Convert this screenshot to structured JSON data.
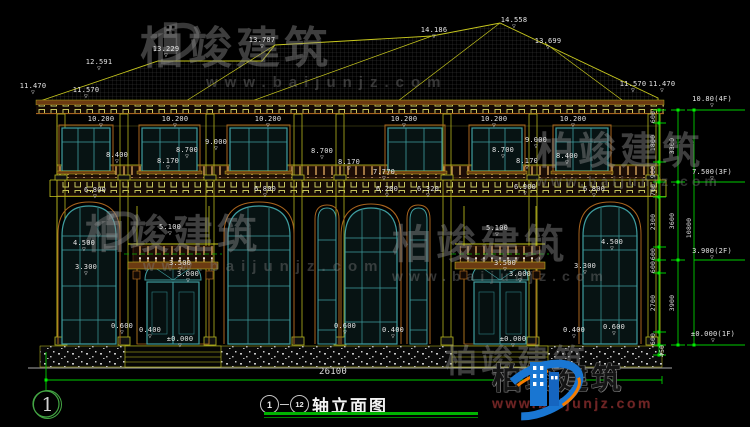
{
  "drawing": {
    "title": "轴立面图",
    "axis_from": "1",
    "axis_to": "12",
    "sheet_bubble": "1"
  },
  "watermark": {
    "brand": "柏竣建筑",
    "url": "www.baijunjz.com"
  },
  "colors": {
    "cad_yellow": "#c8c81e",
    "trim_brown": "#a8641e",
    "window_teal": "#3f9ea0",
    "dim_green": "#00cc00",
    "text_white": "#e4e4e4",
    "logo_blue": "#1976d2",
    "logo_orange": "#f57c00",
    "url_red": "#6e2424"
  },
  "labels": [
    {
      "t": "11.470",
      "x": 33,
      "y": 86,
      "lv": 1
    },
    {
      "t": "11.570",
      "x": 86,
      "y": 90,
      "lv": 1
    },
    {
      "t": "12.591",
      "x": 99,
      "y": 62,
      "lv": 1
    },
    {
      "t": "13.229",
      "x": 166,
      "y": 49,
      "lv": 1
    },
    {
      "t": "13.707",
      "x": 262,
      "y": 40,
      "lv": 1
    },
    {
      "t": "14.186",
      "x": 434,
      "y": 30,
      "lv": 1
    },
    {
      "t": "14.558",
      "x": 514,
      "y": 20,
      "lv": 1
    },
    {
      "t": "13.699",
      "x": 548,
      "y": 41,
      "lv": 1
    },
    {
      "t": "11.570",
      "x": 633,
      "y": 84,
      "lv": 1
    },
    {
      "t": "11.470",
      "x": 662,
      "y": 84,
      "lv": 1
    },
    {
      "t": "10.200",
      "x": 101,
      "y": 119,
      "lv": 1
    },
    {
      "t": "10.200",
      "x": 175,
      "y": 119,
      "lv": 1
    },
    {
      "t": "10.200",
      "x": 268,
      "y": 119,
      "lv": 1
    },
    {
      "t": "10.200",
      "x": 404,
      "y": 119,
      "lv": 1
    },
    {
      "t": "10.200",
      "x": 494,
      "y": 119,
      "lv": 1
    },
    {
      "t": "10.200",
      "x": 573,
      "y": 119,
      "lv": 1
    },
    {
      "t": "9.000",
      "x": 216,
      "y": 142,
      "lv": 1
    },
    {
      "t": "9.000",
      "x": 536,
      "y": 140,
      "lv": 1
    },
    {
      "t": "8.700",
      "x": 187,
      "y": 150,
      "lv": 1
    },
    {
      "t": "8.700",
      "x": 322,
      "y": 151,
      "lv": 1
    },
    {
      "t": "8.700",
      "x": 503,
      "y": 150,
      "lv": 1
    },
    {
      "t": "8.400",
      "x": 117,
      "y": 155,
      "lv": 1
    },
    {
      "t": "8.400",
      "x": 567,
      "y": 156,
      "lv": 1
    },
    {
      "t": "8.170",
      "x": 168,
      "y": 161,
      "lv": 1
    },
    {
      "t": "8.170",
      "x": 349,
      "y": 162,
      "lv": 1
    },
    {
      "t": "8.170",
      "x": 527,
      "y": 161,
      "lv": 1
    },
    {
      "t": "7.770",
      "x": 384,
      "y": 172,
      "lv": 1
    },
    {
      "t": "6.800",
      "x": 95,
      "y": 190,
      "lv": 1
    },
    {
      "t": "6.800",
      "x": 265,
      "y": 189,
      "lv": 1
    },
    {
      "t": "6.200",
      "x": 387,
      "y": 189,
      "lv": 1
    },
    {
      "t": "6.320",
      "x": 428,
      "y": 189,
      "lv": 1
    },
    {
      "t": "6.900",
      "x": 525,
      "y": 187,
      "lv": 1
    },
    {
      "t": "6.800",
      "x": 594,
      "y": 189,
      "lv": 1
    },
    {
      "t": "5.100",
      "x": 170,
      "y": 227,
      "lv": 1
    },
    {
      "t": "5.100",
      "x": 497,
      "y": 228,
      "lv": 1
    },
    {
      "t": "4.500",
      "x": 84,
      "y": 243,
      "lv": 1
    },
    {
      "t": "4.500",
      "x": 612,
      "y": 242,
      "lv": 1
    },
    {
      "t": "3.500",
      "x": 180,
      "y": 263,
      "lv": 1
    },
    {
      "t": "3.500",
      "x": 505,
      "y": 263,
      "lv": 1
    },
    {
      "t": "3.300",
      "x": 86,
      "y": 267,
      "lv": 1
    },
    {
      "t": "3.300",
      "x": 585,
      "y": 266,
      "lv": 1
    },
    {
      "t": "3.000",
      "x": 188,
      "y": 274,
      "lv": 1
    },
    {
      "t": "3.000",
      "x": 520,
      "y": 274,
      "lv": 1
    },
    {
      "t": "0.600",
      "x": 122,
      "y": 326,
      "lv": 1
    },
    {
      "t": "0.400",
      "x": 150,
      "y": 330,
      "lv": 1
    },
    {
      "t": "±0.000",
      "x": 180,
      "y": 339,
      "lv": 1
    },
    {
      "t": "0.600",
      "x": 345,
      "y": 326,
      "lv": 1
    },
    {
      "t": "0.400",
      "x": 393,
      "y": 330,
      "lv": 1
    },
    {
      "t": "±0.000",
      "x": 513,
      "y": 339,
      "lv": 1
    },
    {
      "t": "0.400",
      "x": 574,
      "y": 330,
      "lv": 1
    },
    {
      "t": "0.600",
      "x": 614,
      "y": 327,
      "lv": 1
    },
    {
      "t": "26100",
      "x": 333,
      "y": 372,
      "big": 1
    },
    {
      "t": "600",
      "x": 653,
      "y": 117,
      "r": 1
    },
    {
      "t": "1800",
      "x": 653,
      "y": 143,
      "r": 1
    },
    {
      "t": "900",
      "x": 653,
      "y": 172,
      "r": 1
    },
    {
      "t": "700",
      "x": 653,
      "y": 190,
      "r": 1
    },
    {
      "t": "2300",
      "x": 653,
      "y": 222,
      "r": 1
    },
    {
      "t": "600",
      "x": 653,
      "y": 254,
      "r": 1
    },
    {
      "t": "600",
      "x": 653,
      "y": 267,
      "r": 1
    },
    {
      "t": "2700",
      "x": 653,
      "y": 303,
      "r": 1
    },
    {
      "t": "600",
      "x": 653,
      "y": 339,
      "r": 1
    },
    {
      "t": "450",
      "x": 662,
      "y": 351,
      "r": 1
    },
    {
      "t": "3300",
      "x": 672,
      "y": 146,
      "r": 1
    },
    {
      "t": "3600",
      "x": 672,
      "y": 221,
      "r": 1
    },
    {
      "t": "3900",
      "x": 672,
      "y": 303,
      "r": 1
    },
    {
      "t": "10800",
      "x": 689,
      "y": 228,
      "r": 1
    },
    {
      "t": "10.80(4F)",
      "x": 712,
      "y": 99,
      "lv": 1
    },
    {
      "t": "7.500(3F)",
      "x": 712,
      "y": 172,
      "lv": 1
    },
    {
      "t": "3.900(2F)",
      "x": 712,
      "y": 251,
      "lv": 1
    },
    {
      "t": "±0.000(1F)",
      "x": 713,
      "y": 334,
      "lv": 1
    }
  ]
}
